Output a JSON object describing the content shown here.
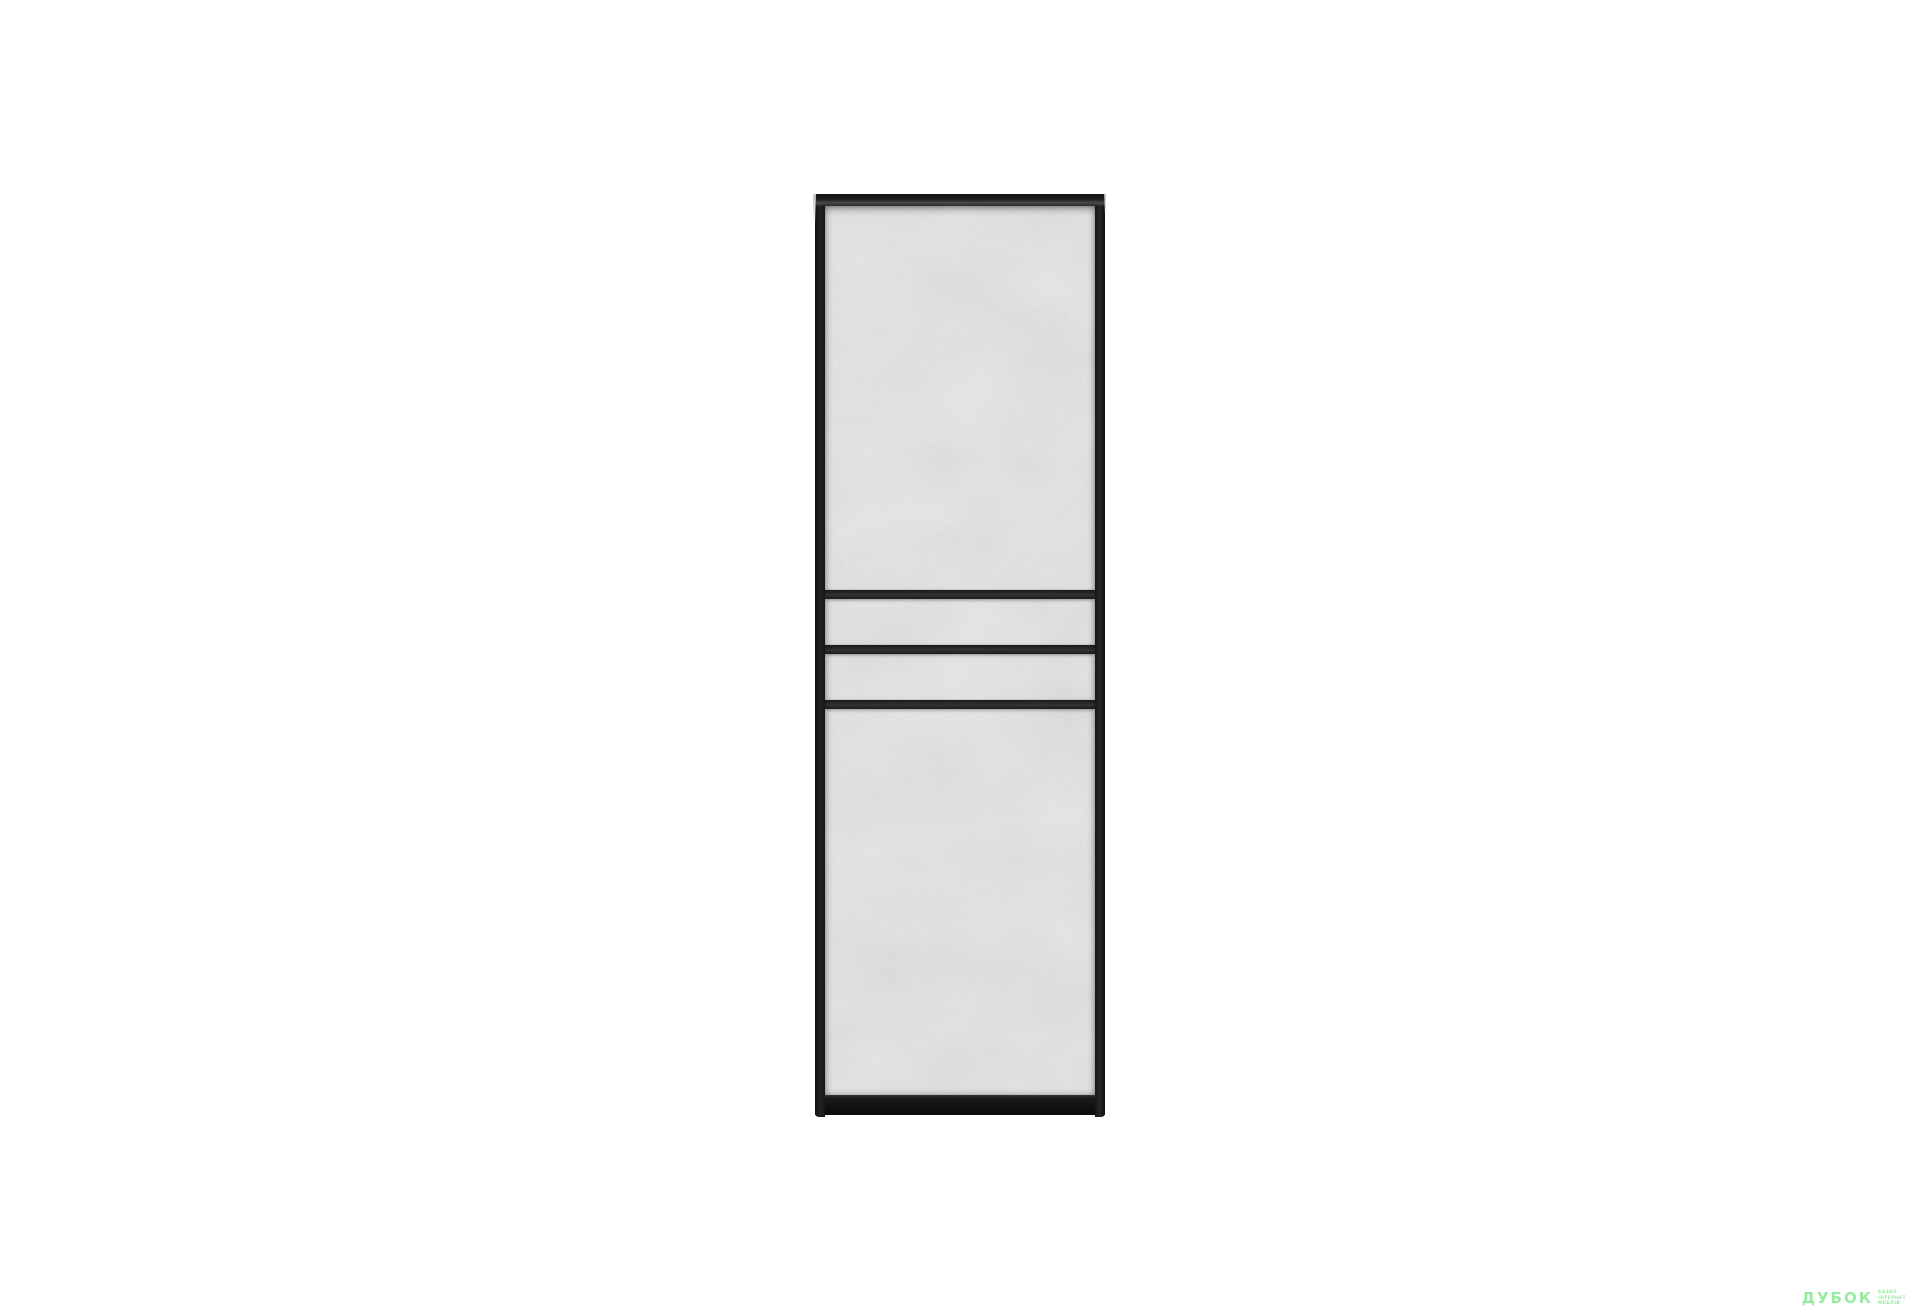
{
  "page": {
    "background_color": "#ffffff"
  },
  "product": {
    "item": "wardrobe-door-panel",
    "frame_color": "#1b1b1b",
    "panel_color": "#d9d8d6",
    "stripe_color": "#262626",
    "stripe_count": 3
  },
  "watermark": {
    "logo_text": "ДУБОК",
    "tagline_lines": [
      "БАЗАР",
      "ІНТЕРНЕТ",
      "МЕБЛІВ"
    ],
    "color": "#92ea9b"
  }
}
